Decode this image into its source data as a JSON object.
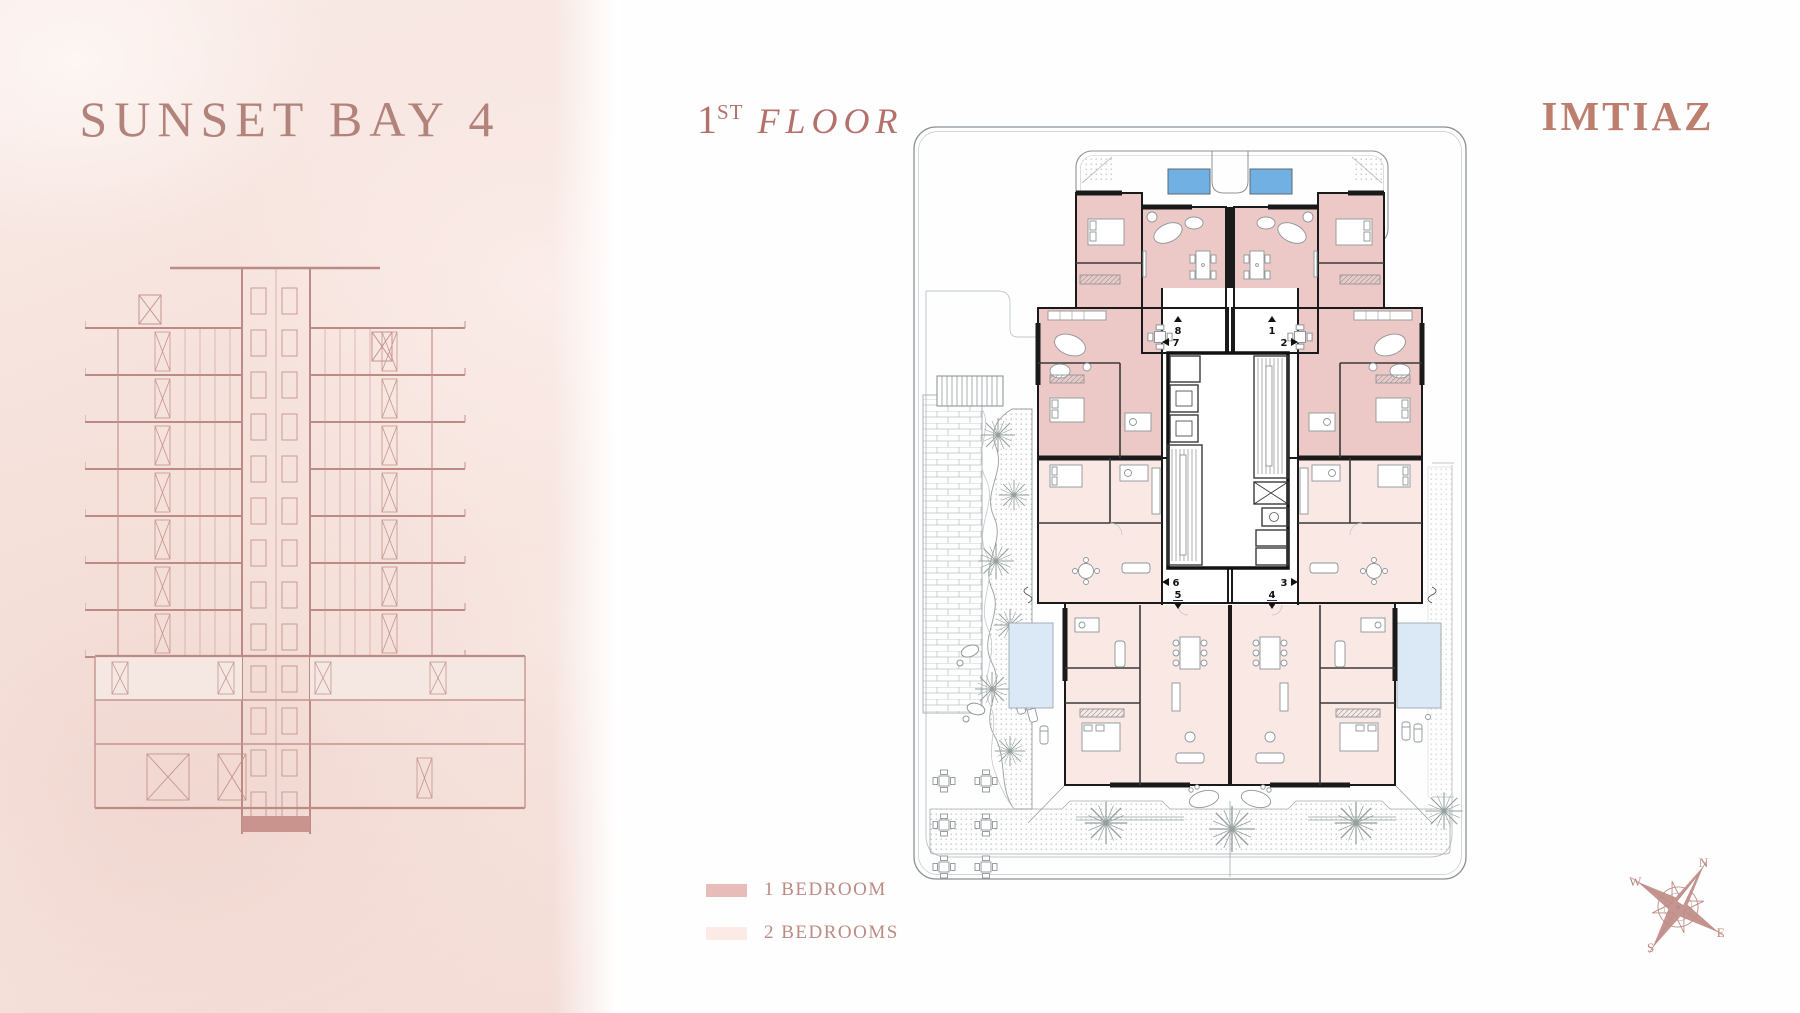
{
  "project": {
    "title": "SUNSET BAY 4",
    "brand": "IMTIAZ"
  },
  "header": {
    "floor_number": "1",
    "floor_suffix": "ST",
    "floor_word": "FLOOR"
  },
  "legend": {
    "items": [
      {
        "label": "1 BEDROOM",
        "swatch_style": "background:#e8bcb8"
      },
      {
        "label": "2 BEDROOMS",
        "swatch_style": "background:#fbeae6"
      }
    ]
  },
  "plan": {
    "units": [
      "1",
      "2",
      "3",
      "4",
      "5",
      "6",
      "7",
      "8"
    ]
  },
  "compass": {
    "n": "N",
    "e": "E",
    "s": "S",
    "w": "W"
  },
  "colors": {
    "one_bedroom_fill": "#ecc9c7",
    "two_bedroom_fill": "#f9e8e4",
    "pool_blue": "#70b0e2",
    "side_pool_blue": "#dbe9f6",
    "accent_rose": "#b2837b",
    "elevation_rose": "#c5948e"
  }
}
